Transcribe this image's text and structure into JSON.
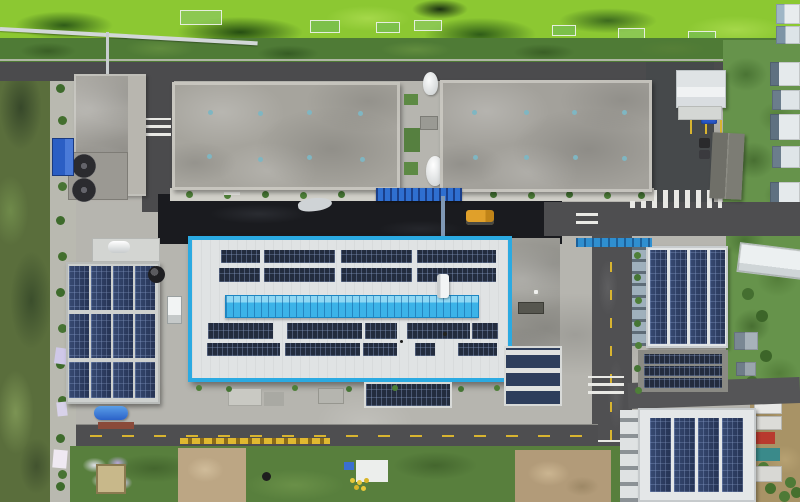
{
  "scene": {
    "type": "aerial-photograph",
    "subject": "Drone top-down view of an industrial plant campus with rooftop solar photovoltaic arrays, roads, crosswalks and surrounding vegetation",
    "visible_text": [],
    "palette": {
      "algae_green": "#8cc832",
      "tree_band_green": "#4f7b36",
      "reed_green": "#5a6e3c",
      "field_green": "#66934b",
      "orchard_tan": "#a89366",
      "asphalt_gray": "#4e4e50",
      "fresh_asphalt_dark": "#1a1b1f",
      "concrete_light": "#b6b5af",
      "roof_gray": "#a6a49d",
      "roof_white": "#e0e3e4",
      "solar_panel_dark": "#232c3e",
      "solar_panel_blue": "#2b3a5c",
      "main_building_border_blue": "#2baae2",
      "skylight_strip_blue": "#3cb3e8",
      "road_marking_yellow": "#d8b430",
      "crosswalk_white": "#e9e9e5",
      "tarp_blue": "#2b5ec4",
      "dirt_tan": "#bca684"
    },
    "landmarks": [
      {
        "name": "algae-pond-strip",
        "description": "bright green algae-covered water with net cages, top edge"
      },
      {
        "name": "tree-band",
        "description": "dark green tree/shrub belt below the pond"
      },
      {
        "name": "warehouse-roof-west",
        "description": "large mottled gray flat roof with skylight dots"
      },
      {
        "name": "warehouse-roof-east",
        "description": "large mottled gray flat roof with skylight dots"
      },
      {
        "name": "main-solar-building",
        "description": "white roof outlined in bright blue, rows of dark solar arrays and a cyan skylight strip"
      },
      {
        "name": "west-solar-building",
        "description": "roof fully covered by four columns of blue solar panels"
      },
      {
        "name": "northeast-solar-building",
        "description": "white roof with four solar panel columns plus solar carport rows"
      },
      {
        "name": "southeast-solar-building",
        "description": "white roof with four solar panel columns"
      },
      {
        "name": "road-network",
        "description": "asphalt roads with yellow dashed lines and white zebra crossings"
      },
      {
        "name": "construction-ground",
        "description": "bottom dirt and scrub area with tarps and debris"
      }
    ]
  }
}
